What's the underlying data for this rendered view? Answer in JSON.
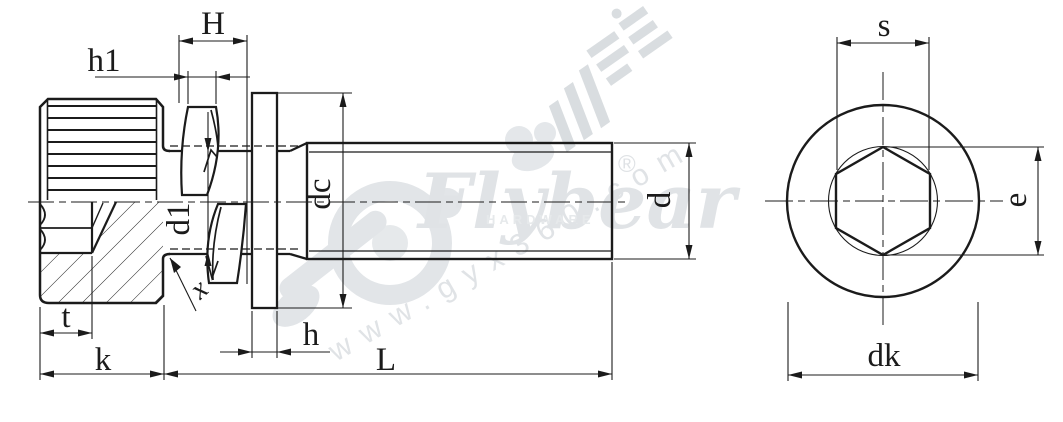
{
  "dimension_labels": {
    "H": "H",
    "h1": "h1",
    "d1": "d1",
    "x": "x",
    "dc": "dc",
    "d": "d",
    "t": "t",
    "k": "k",
    "h": "h",
    "L": "L",
    "s": "s",
    "e": "e",
    "dk": "dk"
  },
  "watermark": {
    "brand": "Flybear",
    "brand_subtitle": "HARDWARE",
    "registered_mark": "®",
    "website": "www.gyx360.com"
  },
  "colors": {
    "line_color": "#1b1b1b",
    "watermark_color": "#e2e5e8",
    "background": "#ffffff"
  }
}
